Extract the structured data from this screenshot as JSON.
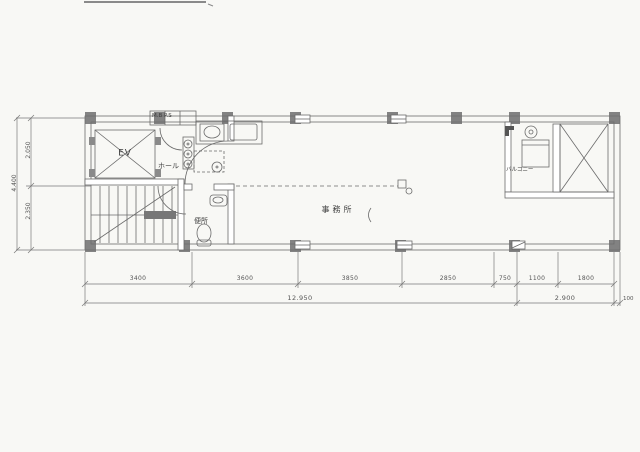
{
  "drawing": {
    "rooms": {
      "elevator": "EV",
      "hall": "ホール",
      "toilet": "便所",
      "office": "事務所",
      "balcony": "バルコニー",
      "meter_box": "M.B P.S"
    },
    "dimensions": {
      "left": {
        "upper": "2.050",
        "lower": "2.350",
        "total": "4.400"
      },
      "bottom": {
        "segments": [
          "3400",
          "3600",
          "3850",
          "2850",
          "750",
          "1100",
          "1800"
        ],
        "total_main": "12.950",
        "total_right": "2.900",
        "wall": "100"
      }
    },
    "colors": {
      "paper": "#f8f8f5",
      "line": "#6b6b6b",
      "ink": "#454545"
    }
  }
}
